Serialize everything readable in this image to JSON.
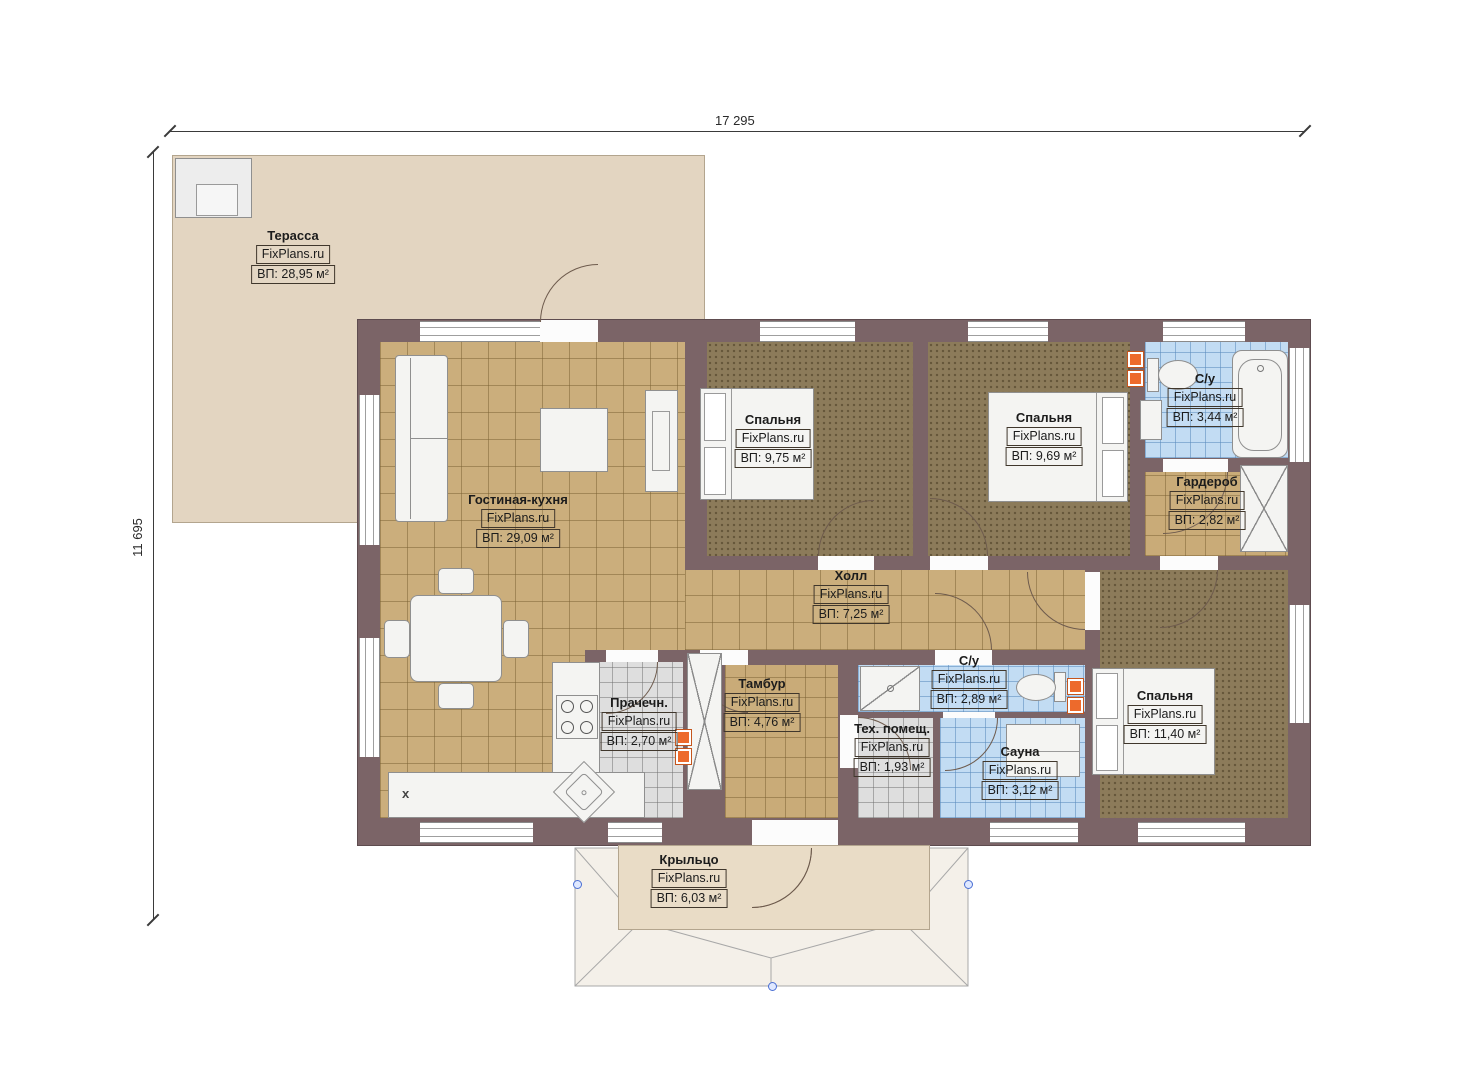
{
  "title": "FixPlans.ru floor plan",
  "watermark": "FixPlans.ru",
  "dimensions": {
    "width_label": "17 295",
    "height_label": "11 695"
  },
  "rooms": [
    {
      "name": "Терасса",
      "area": "ВП: 28,95 м²"
    },
    {
      "name": "Гостиная-кухня",
      "area": "ВП: 29,09 м²"
    },
    {
      "name": "Спальня",
      "area": "ВП: 9,75 м²"
    },
    {
      "name": "Спальня",
      "area": "ВП: 9,69 м²"
    },
    {
      "name": "С/у",
      "area": "ВП: 3,44 м²"
    },
    {
      "name": "Гардероб",
      "area": "ВП: 2,82 м²"
    },
    {
      "name": "Холл",
      "area": "ВП: 7,25 м²"
    },
    {
      "name": "Прачечн.",
      "area": "ВП: 2,70 м²"
    },
    {
      "name": "Тамбур",
      "area": "ВП: 4,76 м²"
    },
    {
      "name": "С/у",
      "area": "ВП: 2,89 м²"
    },
    {
      "name": "Тех. помещ.",
      "area": "ВП: 1,93 м²"
    },
    {
      "name": "Сауна",
      "area": "ВП: 3,12 м²"
    },
    {
      "name": "Спальня",
      "area": "ВП: 11,40 м²"
    },
    {
      "name": "Крыльцо",
      "area": "ВП: 6,03 м²"
    }
  ],
  "markers": {
    "kitchen_x": "x"
  },
  "colors": {
    "wall": "#7b6467",
    "terrace": "#e3d5c1",
    "tile_tan": "#cbae7c",
    "tile_blue": "#c2dcf3",
    "tile_gray": "#dedede",
    "bedroom_floor": "#8c7b5a",
    "accent_orange": "#ed6a2c",
    "marker_blue": "#4a6fd4"
  }
}
